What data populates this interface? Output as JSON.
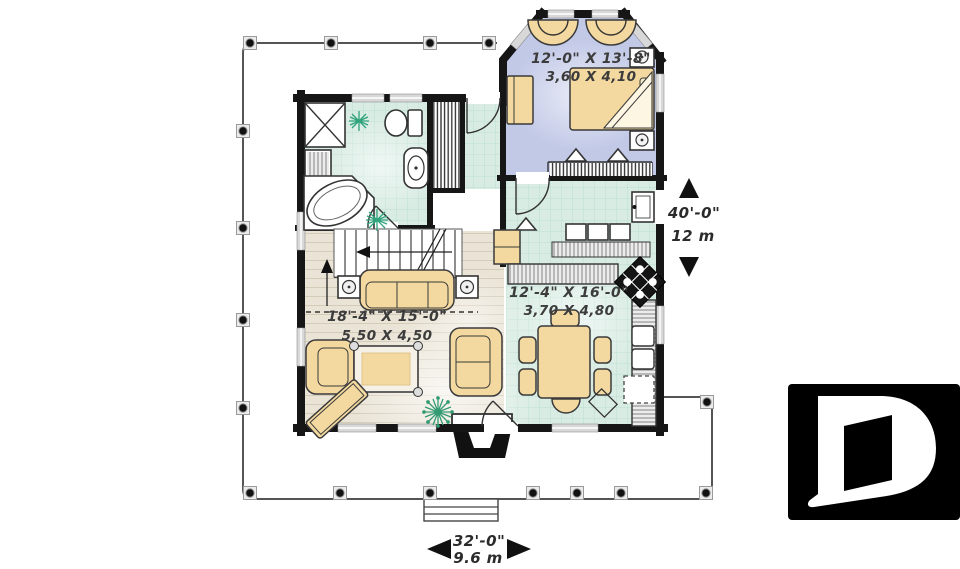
{
  "plan": {
    "title": "house-first-floor-plan",
    "rooms": {
      "bedroom": {
        "imperial": "12'-0\" X 13'-8\"",
        "metric": "3,60 X 4,10"
      },
      "living": {
        "imperial": "18'-4\" X 15'-0\"",
        "metric": "5,50 X 4,50"
      },
      "dining": {
        "imperial": "12'-4\" X 16'-0\"",
        "metric": "3,70 X 4,80"
      }
    },
    "dimensions": {
      "depth": {
        "imperial": "40'-0\"",
        "metric": "12 m"
      },
      "width": {
        "imperial": "32'-0\"",
        "metric": "9.6 m"
      }
    },
    "colors": {
      "wall": "#161616",
      "bedroom_floor": "#c2c9e7",
      "tile_floor": "#d9ece4",
      "wood_floor": "#eae4d6",
      "furniture": "#f3d9a0",
      "plant_green": "#2fa37c",
      "logo_bg": "#000000",
      "logo_fg": "#ffffff"
    },
    "icons": {
      "logo": "drummond-d-logo",
      "plant": "snowflake-plant-icon",
      "stairs_direction": "up-arrow-icon"
    }
  }
}
